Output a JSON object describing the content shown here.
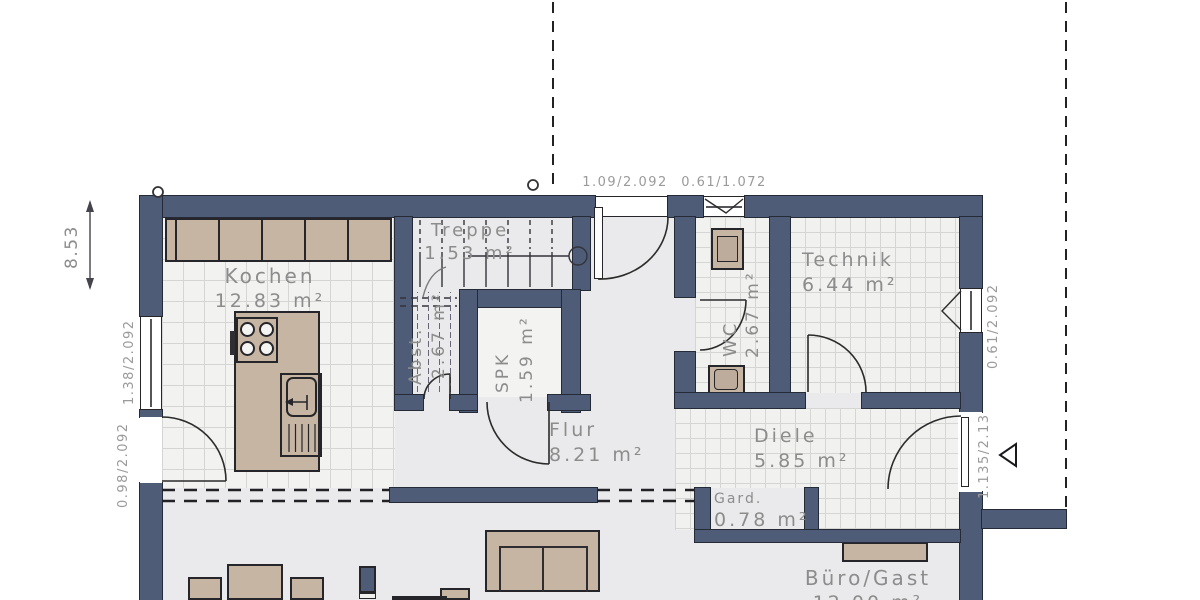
{
  "rooms": {
    "kochen": {
      "name": "Kochen",
      "area": "12.83 m²"
    },
    "treppe": {
      "name": "Treppe",
      "area": "1.53 m²"
    },
    "abst": {
      "name": "Abst.",
      "area": "2.67 m²"
    },
    "spk": {
      "name": "SPK",
      "area": "1.59 m²"
    },
    "wc": {
      "name": "WC",
      "area": "2.67 m²"
    },
    "technik": {
      "name": "Technik",
      "area": "6.44 m²"
    },
    "flur": {
      "name": "Flur",
      "area": "8.21 m²"
    },
    "diele": {
      "name": "Diele",
      "area": "5.85 m²"
    },
    "gard": {
      "name": "Gard.",
      "area": "0.78 m²"
    },
    "buero_gast": {
      "name": "Büro/Gast",
      "area": "12.00 m²"
    }
  },
  "dimensions": {
    "overall_height": "8.53",
    "window_left": "1.38/2.092",
    "door_left": "0.98/2.092",
    "door_top": "1.09/2.092",
    "window_wc": "0.61/1.072",
    "window_technik": "0.61/2.092",
    "door_entrance": "1.135/2.13"
  },
  "colors": {
    "wall": "#4e5c77",
    "furniture": "#c7b5a4",
    "floor_plain": "#eaeaec",
    "floor_tile": "#f2f2f0",
    "label_text": "#8c8c8c",
    "dimension_text": "#9a9a9a",
    "line": "#2b2b2b"
  }
}
